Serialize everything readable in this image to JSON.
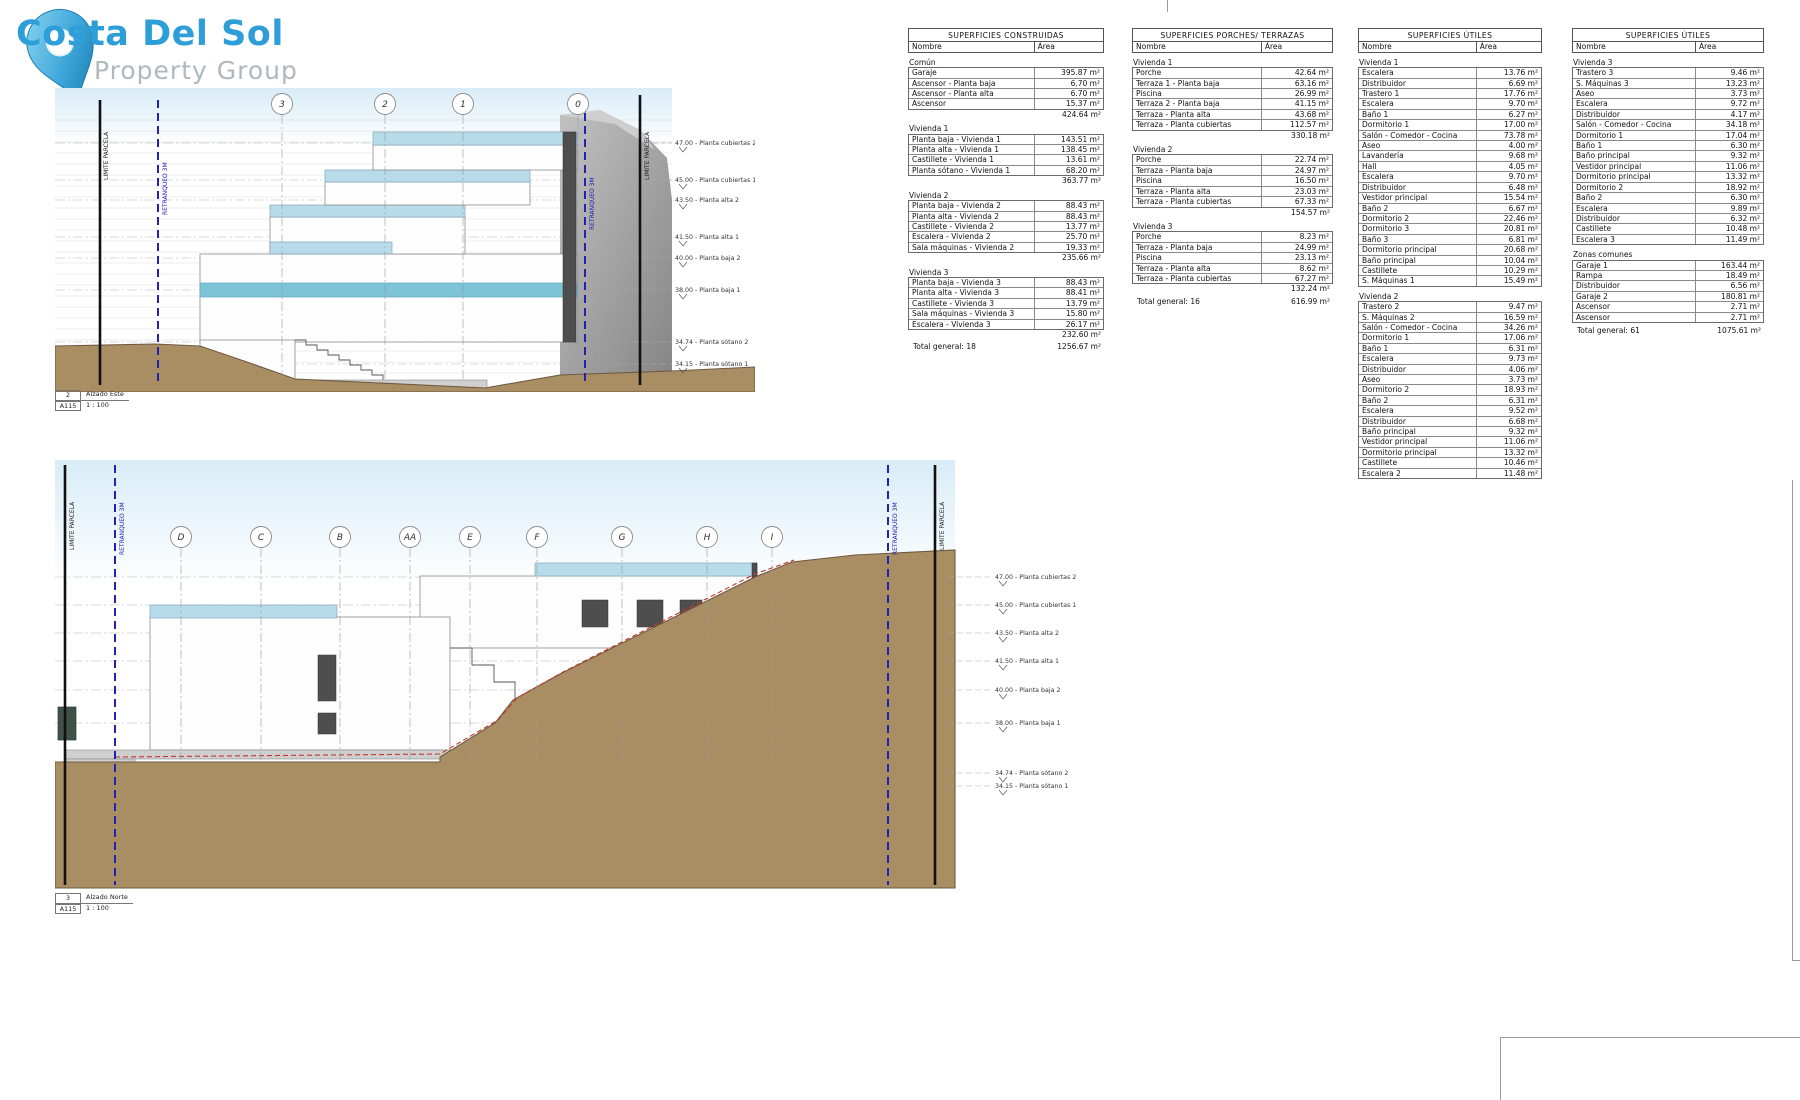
{
  "logo": {
    "title": "Costa Del Sol",
    "subtitle": "Property Group"
  },
  "drawings": [
    {
      "number": "2",
      "name": "Alzado Este",
      "sheet": "A115",
      "scale": "1 : 100",
      "boundary_label": "LIMITE PARCELA",
      "setback_label": "RETRANQUEO 3M",
      "grid_bubbles": [
        "3",
        "2",
        "1",
        "0"
      ],
      "levels": [
        {
          "value": "47.00",
          "label": "Planta cubiertas 2"
        },
        {
          "value": "45.00",
          "label": "Planta cubiertas 1"
        },
        {
          "value": "43.50",
          "label": "Planta alta 2"
        },
        {
          "value": "41.50",
          "label": "Planta alta 1"
        },
        {
          "value": "40.00",
          "label": "Planta baja 2"
        },
        {
          "value": "38.00",
          "label": "Planta baja 1"
        },
        {
          "value": "34.74",
          "label": "Planta sótano 2"
        },
        {
          "value": "34.15",
          "label": "Planta sótano 1"
        }
      ]
    },
    {
      "number": "3",
      "name": "Alzado Norte",
      "sheet": "A115",
      "scale": "1 : 100",
      "boundary_label": "LIMITE PARCELA",
      "setback_label": "RETRANQUEO 3M",
      "grid_bubbles": [
        "D",
        "C",
        "B",
        "AA",
        "E",
        "F",
        "G",
        "H",
        "I"
      ],
      "levels": [
        {
          "value": "47.00",
          "label": "Planta cubiertas 2"
        },
        {
          "value": "45.00",
          "label": "Planta cubiertas 1"
        },
        {
          "value": "43.50",
          "label": "Planta alta 2"
        },
        {
          "value": "41.50",
          "label": "Planta alta 1"
        },
        {
          "value": "40.00",
          "label": "Planta baja 2"
        },
        {
          "value": "38.00",
          "label": "Planta baja 1"
        },
        {
          "value": "34.74",
          "label": "Planta sótano 2"
        },
        {
          "value": "34.15",
          "label": "Planta sótano 1"
        }
      ]
    }
  ],
  "tables": [
    {
      "title": "SUPERFICIES CONSTRUIDAS",
      "col_nombre": "Nombre",
      "col_area": "Área",
      "groups": [
        {
          "name": "Común",
          "rows": [
            [
              "Garaje",
              "395.87 m²"
            ],
            [
              "Ascensor - Planta baja",
              "6.70 m²"
            ],
            [
              "Ascensor - Planta alta",
              "6.70 m²"
            ],
            [
              "Ascensor",
              "15.37 m²"
            ]
          ],
          "subtotal": "424.64 m²"
        },
        {
          "name": "Vivienda 1",
          "rows": [
            [
              "Planta baja - Vivienda 1",
              "143.51 m²"
            ],
            [
              "Planta alta - Vivienda 1",
              "138.45 m²"
            ],
            [
              "Castillete - Vivienda 1",
              "13.61 m²"
            ],
            [
              "Planta sótano - Vivienda 1",
              "68.20 m²"
            ]
          ],
          "subtotal": "363.77 m²"
        },
        {
          "name": "Vivienda 2",
          "rows": [
            [
              "Planta baja - Vivienda 2",
              "88.43 m²"
            ],
            [
              "Planta alta - Vivienda 2",
              "88.43 m²"
            ],
            [
              "Castillete - Vivienda 2",
              "13.77 m²"
            ],
            [
              "Escalera - Vivienda 2",
              "25.70 m²"
            ],
            [
              "Sala máquinas - Vivienda 2",
              "19.33 m²"
            ]
          ],
          "subtotal": "235.66 m²"
        },
        {
          "name": "Vivienda 3",
          "rows": [
            [
              "Planta baja - Vivienda 3",
              "88.43 m²"
            ],
            [
              "Planta alta - Vivienda 3",
              "88.41 m²"
            ],
            [
              "Castillete - Vivienda 3",
              "13.79 m²"
            ],
            [
              "Sala máquinas - Vivienda 3",
              "15.80 m²"
            ],
            [
              "Escalera - Vivienda 3",
              "26.17 m²"
            ]
          ],
          "subtotal": "232.60 m²"
        }
      ],
      "total": {
        "label": "Total general: 18",
        "value": "1256.67 m²"
      }
    },
    {
      "title": "SUPERFICIES PORCHES/ TERRAZAS",
      "col_nombre": "Nombre",
      "col_area": "Área",
      "groups": [
        {
          "name": "Vivienda 1",
          "rows": [
            [
              "Porche",
              "42.64 m²"
            ],
            [
              "Terraza 1 - Planta baja",
              "63.16 m²"
            ],
            [
              "Piscina",
              "26.99 m²"
            ],
            [
              "Terraza 2 - Planta baja",
              "41.15 m²"
            ],
            [
              "Terraza - Planta alta",
              "43.68 m²"
            ],
            [
              "Terraza - Planta cubiertas",
              "112.57 m²"
            ]
          ],
          "subtotal": "330.18 m²"
        },
        {
          "name": "Vivienda 2",
          "rows": [
            [
              "Porche",
              "22.74 m²"
            ],
            [
              "Terraza - Planta baja",
              "24.97 m²"
            ],
            [
              "Piscina",
              "16.50 m²"
            ],
            [
              "Terraza - Planta alta",
              "23.03 m²"
            ],
            [
              "Terraza - Planta cubiertas",
              "67.33 m²"
            ]
          ],
          "subtotal": "154.57 m²"
        },
        {
          "name": "Vivienda 3",
          "rows": [
            [
              "Porche",
              "8.23 m²"
            ],
            [
              "Terraza - Planta baja",
              "24.99 m²"
            ],
            [
              "Piscina",
              "23.13 m²"
            ],
            [
              "Terraza - Planta alta",
              "8.62 m²"
            ],
            [
              "Terraza - Planta cubiertas",
              "67.27 m²"
            ]
          ],
          "subtotal": "132.24 m²"
        }
      ],
      "total": {
        "label": "Total general: 16",
        "value": "616.99 m²"
      }
    },
    {
      "title": "SUPERFICIES ÚTILES",
      "col_nombre": "Nombre",
      "col_area": "Área",
      "groups": [
        {
          "name": "Vivienda 1",
          "rows": [
            [
              "Escalera",
              "13.76 m²"
            ],
            [
              "Distribuidor",
              "6.69 m²"
            ],
            [
              "Trastero 1",
              "17.76 m²"
            ],
            [
              "Escalera",
              "9.70 m²"
            ],
            [
              "Baño 1",
              "6.27 m²"
            ],
            [
              "Dormitorio 1",
              "17.00 m²"
            ],
            [
              "Salón - Comedor - Cocina",
              "73.78 m²"
            ],
            [
              "Aseo",
              "4.00 m²"
            ],
            [
              "Lavandería",
              "9.68 m²"
            ],
            [
              "Hall",
              "4.05 m²"
            ],
            [
              "Escalera",
              "9.70 m²"
            ],
            [
              "Distribuidor",
              "6.48 m²"
            ],
            [
              "Vestidor principal",
              "15.54 m²"
            ],
            [
              "Baño 2",
              "6.67 m²"
            ],
            [
              "Dormitorio 2",
              "22.46 m²"
            ],
            [
              "Dormitorio 3",
              "20.81 m²"
            ],
            [
              "Baño 3",
              "6.81 m²"
            ],
            [
              "Dormitorio principal",
              "20.68 m²"
            ],
            [
              "Baño principal",
              "10.04 m²"
            ],
            [
              "Castillete",
              "10.29 m²"
            ],
            [
              "S. Máquinas 1",
              "15.49 m²"
            ]
          ]
        },
        {
          "name": "Vivienda 2",
          "rows": [
            [
              "Trastero 2",
              "9.47 m²"
            ],
            [
              "S. Máquinas 2",
              "16.59 m²"
            ],
            [
              "Salón - Comedor - Cocina",
              "34.26 m²"
            ],
            [
              "Dormitorio 1",
              "17.06 m²"
            ],
            [
              "Baño 1",
              "6.31 m²"
            ],
            [
              "Escalera",
              "9.73 m²"
            ],
            [
              "Distribuidor",
              "4.06 m²"
            ],
            [
              "Aseo",
              "3.73 m²"
            ],
            [
              "Dormitorio 2",
              "18.93 m²"
            ],
            [
              "Baño 2",
              "6.31 m²"
            ],
            [
              "Escalera",
              "9.52 m²"
            ],
            [
              "Distribuidor",
              "6.68 m²"
            ],
            [
              "Baño principal",
              "9.32 m²"
            ],
            [
              "Vestidor principal",
              "11.06 m²"
            ],
            [
              "Dormitorio principal",
              "13.32 m²"
            ],
            [
              "Castillete",
              "10.46 m²"
            ],
            [
              "Escalera 2",
              "11.48 m²"
            ]
          ]
        }
      ]
    },
    {
      "title": "SUPERFICIES ÚTILES",
      "col_nombre": "Nombre",
      "col_area": "Área",
      "groups": [
        {
          "name": "Vivienda 3",
          "rows": [
            [
              "Trastero 3",
              "9.46 m²"
            ],
            [
              "S. Máquinas 3",
              "13.23 m²"
            ],
            [
              "Aseo",
              "3.73 m²"
            ],
            [
              "Escalera",
              "9.72 m²"
            ],
            [
              "Distribuidor",
              "4.17 m²"
            ],
            [
              "Salón - Comedor - Cocina",
              "34.18 m²"
            ],
            [
              "Dormitorio 1",
              "17.04 m²"
            ],
            [
              "Baño 1",
              "6.30 m²"
            ],
            [
              "Baño principal",
              "9.32 m²"
            ],
            [
              "Vestidor principal",
              "11.06 m²"
            ],
            [
              "Dormitorio principal",
              "13.32 m²"
            ],
            [
              "Dormitorio 2",
              "18.92 m²"
            ],
            [
              "Baño 2",
              "6.30 m²"
            ],
            [
              "Escalera",
              "9.89 m²"
            ],
            [
              "Distribuidor",
              "6.32 m²"
            ],
            [
              "Castillete",
              "10.48 m²"
            ],
            [
              "Escalera 3",
              "11.49 m²"
            ]
          ]
        },
        {
          "name": "Zonas comunes",
          "rows": [
            [
              "Garaje 1",
              "163.44 m²"
            ],
            [
              "Rampa",
              "18.49 m²"
            ],
            [
              "Distribuidor",
              "6.56 m²"
            ],
            [
              "Garaje 2",
              "180.81 m²"
            ],
            [
              "Ascensor",
              "2.71 m²"
            ],
            [
              "Ascensor",
              "2.71 m²"
            ]
          ]
        }
      ],
      "total": {
        "label": "Total general: 61",
        "value": "1075.61 m²"
      }
    }
  ]
}
